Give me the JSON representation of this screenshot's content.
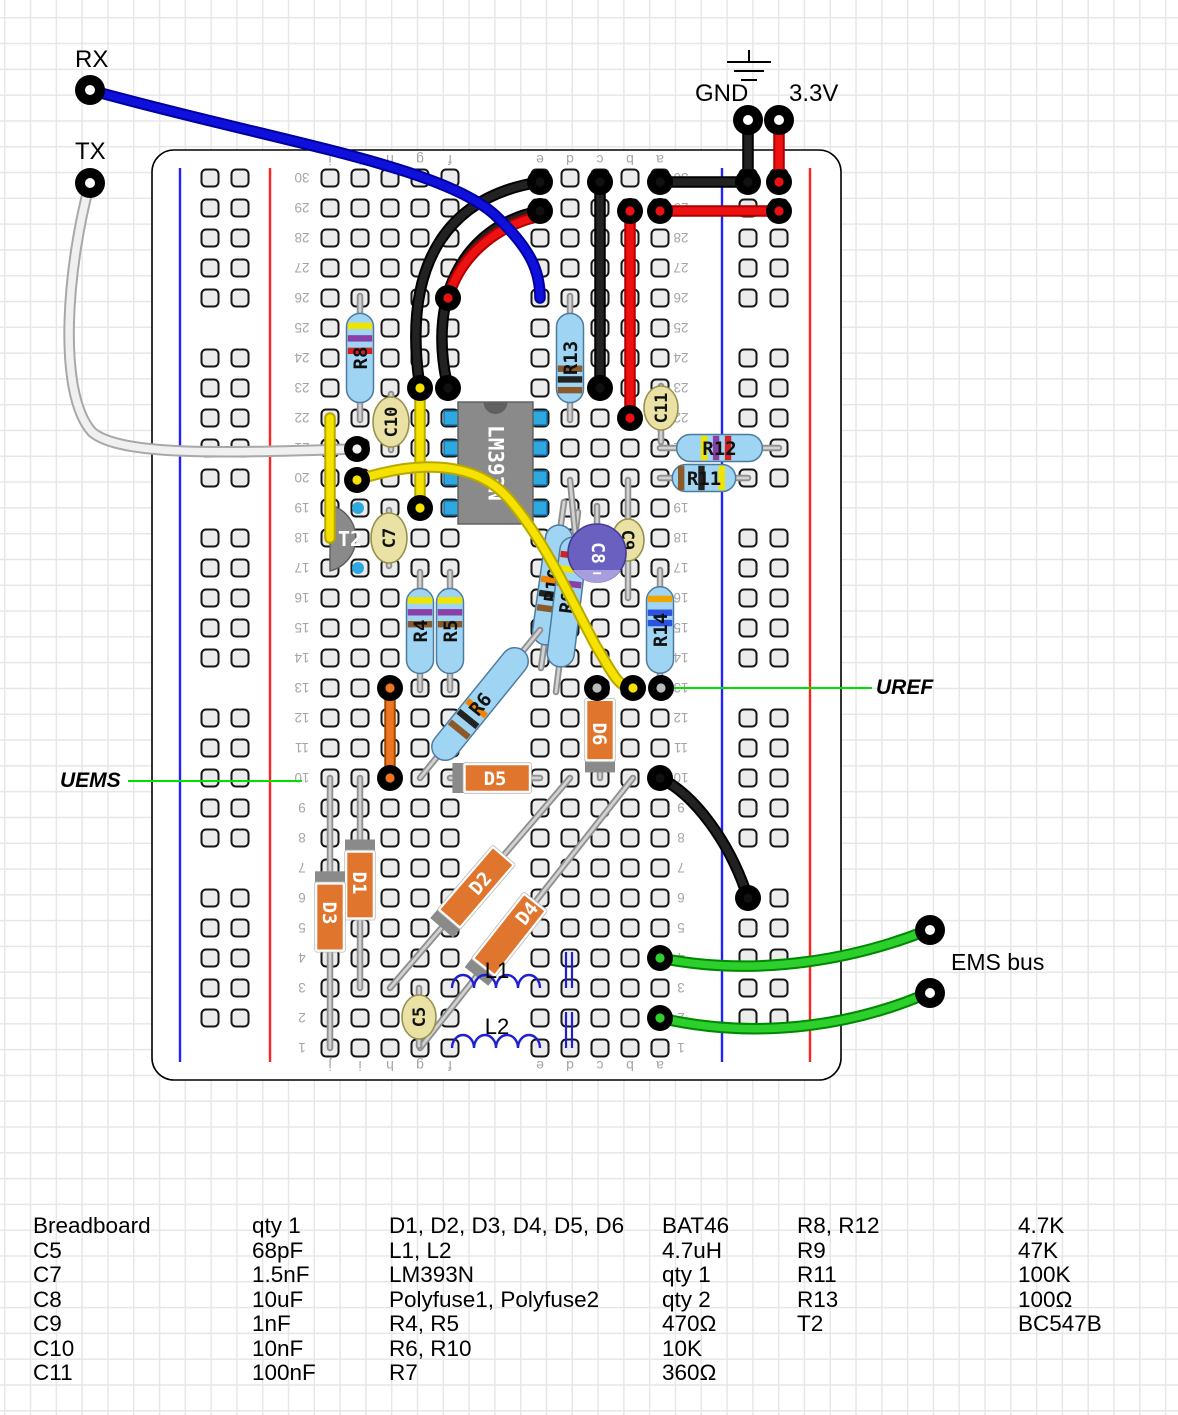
{
  "annotations": {
    "rx": "RX",
    "tx": "TX",
    "gnd": "GND",
    "v33": "3.3V",
    "uref": "UREF",
    "uems": "UEMS",
    "ems_bus": "EMS bus"
  },
  "board": {
    "row_numbers": [
      "1",
      "2",
      "3",
      "4",
      "5",
      "6",
      "7",
      "8",
      "9",
      "10",
      "11",
      "12",
      "13",
      "14",
      "15",
      "16",
      "17",
      "18",
      "19",
      "20",
      "21",
      "22",
      "23",
      "24",
      "25",
      "26",
      "27",
      "28",
      "29",
      "30"
    ],
    "column_letters": [
      "a",
      "b",
      "c",
      "d",
      "e",
      "f",
      "g",
      "h",
      "i",
      "j"
    ]
  },
  "colors": {
    "wire_black": "#1a1a1a",
    "wire_red": "#ee1111",
    "wire_blue": "#1010dd",
    "wire_yellow": "#f6e200",
    "wire_green": "#2ccf2c",
    "wire_orange": "#ee7622",
    "wire_white": "#f0f0f0",
    "annotation_green": "#00e100",
    "resistor_body": "#9fd5f2",
    "diode_body": "#e0762e",
    "cap_body": "#e9e2a4",
    "ecap_body": "#6a60c0",
    "ic_body": "#8a8a8a",
    "rail_red": "#ff2222",
    "rail_blue": "#2222ff"
  },
  "components": [
    {
      "t": "res",
      "label": "R8",
      "x1": 360,
      "y1": 420,
      "x2": 360,
      "y2": 296,
      "bands": [
        [
          0.86,
          "#efe400"
        ],
        [
          0.72,
          "#8a3fa8"
        ],
        [
          0.58,
          "#d42222"
        ]
      ]
    },
    {
      "t": "res",
      "label": "R13",
      "x1": 570,
      "y1": 420,
      "x2": 570,
      "y2": 296,
      "bands": [
        [
          0.38,
          "#8a5a2a"
        ],
        [
          0.26,
          "#222222"
        ],
        [
          0.14,
          "#8a5a2a"
        ]
      ]
    },
    {
      "t": "res",
      "label": "R12",
      "x1": 660,
      "y1": 448,
      "x2": 779,
      "y2": 448,
      "bands": [
        [
          0.32,
          "#efe400"
        ],
        [
          0.46,
          "#8a3fa8"
        ],
        [
          0.6,
          "#d42222"
        ]
      ]
    },
    {
      "t": "res",
      "label": "R11",
      "x1": 660,
      "y1": 478,
      "x2": 748,
      "y2": 478,
      "bands": [
        [
          0.14,
          "#8a5a2a"
        ],
        [
          0.46,
          "#222222"
        ],
        [
          0.78,
          "#efe400"
        ]
      ]
    },
    {
      "t": "res",
      "label": "R4",
      "x1": 420,
      "y1": 690,
      "x2": 420,
      "y2": 572,
      "bands": [
        [
          0.86,
          "#efe400"
        ],
        [
          0.72,
          "#8a3fa8"
        ],
        [
          0.58,
          "#8a5a2a"
        ]
      ]
    },
    {
      "t": "res",
      "label": "R5",
      "x1": 450,
      "y1": 690,
      "x2": 450,
      "y2": 572,
      "bands": [
        [
          0.86,
          "#efe400"
        ],
        [
          0.72,
          "#8a3fa8"
        ],
        [
          0.58,
          "#8a5a2a"
        ]
      ]
    },
    {
      "t": "res",
      "label": "R14",
      "x1": 660,
      "y1": 690,
      "x2": 660,
      "y2": 570,
      "bands": [
        [
          0.86,
          "#efa400"
        ],
        [
          0.7,
          "#2b52e0"
        ],
        [
          0.58,
          "#2b52e0"
        ]
      ]
    },
    {
      "t": "res",
      "label": "R10",
      "x1": 541,
      "y1": 668,
      "x2": 564,
      "y2": 502,
      "bands": [
        [
          0.3,
          "#8a5a2a"
        ],
        [
          0.42,
          "#222222"
        ],
        [
          0.54,
          "#ef8400"
        ]
      ]
    },
    {
      "t": "res",
      "label": "R9",
      "x1": 556,
      "y1": 692,
      "x2": 578,
      "y2": 512,
      "bands": [
        [
          0.64,
          "#8a3fa8"
        ],
        [
          0.75,
          "#efe400"
        ],
        [
          0.86,
          "#d42222"
        ]
      ]
    },
    {
      "t": "res",
      "label": "R6",
      "x1": 420,
      "y1": 778,
      "x2": 540,
      "y2": 630,
      "bands": [
        [
          0.26,
          "#8a5a2a"
        ],
        [
          0.36,
          "#222222"
        ],
        [
          0.46,
          "#ef8400"
        ]
      ]
    },
    {
      "t": "dio",
      "label": "D1",
      "x1": 360,
      "y1": 778,
      "x2": 360,
      "y2": 988,
      "b0": 0.35,
      "b1": 0.67,
      "bar": "start"
    },
    {
      "t": "dio",
      "label": "D3",
      "x1": 330,
      "y1": 778,
      "x2": 330,
      "y2": 1048,
      "b0": 0.39,
      "b1": 0.64,
      "bar": "start"
    },
    {
      "t": "dio",
      "label": "D6",
      "x1": 600,
      "y1": 690,
      "x2": 600,
      "y2": 778,
      "b0": 0.11,
      "b1": 0.8,
      "bar": "end"
    },
    {
      "t": "dio",
      "label": "D5",
      "x1": 450,
      "y1": 778,
      "x2": 540,
      "y2": 778,
      "b0": 0.16,
      "b1": 0.89,
      "bar": "start"
    },
    {
      "t": "dio",
      "label": "D2",
      "x1": 390,
      "y1": 988,
      "x2": 570,
      "y2": 778,
      "b0": 0.33,
      "b1": 0.63,
      "bar": "start"
    },
    {
      "t": "dio",
      "label": "D4",
      "x1": 420,
      "y1": 1048,
      "x2": 633,
      "y2": 778,
      "b0": 0.3,
      "b1": 0.54,
      "bar": "start"
    },
    {
      "t": "cap",
      "label": "C10",
      "x": 391,
      "y": 422,
      "l1": 394,
      "l2": 450,
      "rx": 18,
      "ry": 25,
      "rot": -90
    },
    {
      "t": "cap",
      "label": "C7",
      "x": 389,
      "y": 538,
      "l1": 510,
      "l2": 566,
      "rx": 18,
      "ry": 25,
      "rot": -90
    },
    {
      "t": "cap",
      "label": "C9",
      "x": 628,
      "y": 540,
      "l1": 480,
      "l2": 598,
      "rx": 16,
      "ry": 21,
      "rot": 90
    },
    {
      "t": "cap",
      "label": "C11",
      "x": 661,
      "y": 408,
      "l1": 386,
      "l2": 442,
      "rx": 17,
      "ry": 22,
      "rot": -90
    },
    {
      "t": "cap",
      "label": "C5",
      "x": 419,
      "y": 1017,
      "l1": 988,
      "l2": 1046,
      "rx": 17,
      "ry": 22,
      "rot": -90
    },
    {
      "t": "ecap",
      "label": "C8",
      "x": 597,
      "y": 553,
      "r": 29,
      "minus": "−"
    },
    {
      "t": "ic",
      "label": "LM393N",
      "x": 458,
      "y": 402,
      "w": 75,
      "h": 122,
      "pinys": [
        418,
        448,
        478,
        508
      ]
    },
    {
      "t": "tr",
      "label": "T2",
      "x": 352,
      "y": 538,
      "r": 34
    },
    {
      "t": "ind",
      "label": "L1",
      "x1": 452,
      "x2": 540,
      "y": 988,
      "bx": [
        566,
        572
      ],
      "by1": 952,
      "by2": 988,
      "lx": 497,
      "ly": 971
    },
    {
      "t": "ind",
      "label": "L2",
      "x1": 452,
      "x2": 540,
      "y": 1048,
      "bx": [
        566,
        572
      ],
      "by1": 1012,
      "by2": 1048,
      "lx": 497,
      "ly": 1027
    }
  ],
  "wires": [
    {
      "n": "wire-gnd-row30",
      "c": "black",
      "d": "M660,182 L748,182"
    },
    {
      "n": "wire-33v-row29",
      "c": "red",
      "d": "M660,211 L779,211"
    },
    {
      "n": "wire-gnd-pin",
      "c": "black",
      "d": "M748,120 L748,182"
    },
    {
      "n": "wire-33v-pin",
      "c": "red",
      "d": "M779,120 L779,182"
    },
    {
      "n": "wire-col-c",
      "c": "black",
      "d": "M600,182 L600,388"
    },
    {
      "n": "wire-col-b",
      "c": "red",
      "d": "M630,211 L630,418"
    },
    {
      "n": "wire-arc-a",
      "c": "black",
      "d": "M540,182 C455,195 400,255 420,388"
    },
    {
      "n": "wire-arc-b",
      "c": "black",
      "d": "M540,211 C470,224 425,290 448,388"
    },
    {
      "n": "wire-red-arc",
      "c": "red",
      "d": "M448,298 C462,250 505,222 542,216"
    },
    {
      "n": "wire-rx",
      "c": "blue",
      "d": "M90,90 C270,140 440,165 495,215 C532,250 540,272 540,298"
    },
    {
      "n": "wire-tx",
      "c": "white",
      "d": "M90,183 C68,262 56,392 92,432 C122,458 242,452 354,449"
    },
    {
      "n": "wire-yellow-j",
      "c": "yellow",
      "d": "M330,418 L330,538"
    },
    {
      "n": "wire-yellow-g",
      "c": "yellow",
      "d": "M420,388 L420,508"
    },
    {
      "n": "wire-yellow-s",
      "c": "yellow",
      "d": "M357,480 C425,458 478,464 508,498 C545,540 572,602 596,646 C612,672 618,688 633,688"
    },
    {
      "n": "wire-orange",
      "c": "orange",
      "d": "M390,688 L390,778"
    },
    {
      "n": "wire-a10-rail",
      "c": "black",
      "d": "M660,778 C694,794 730,842 748,898"
    },
    {
      "n": "wire-ems-1",
      "c": "green",
      "d": "M660,958 C760,978 858,958 928,930"
    },
    {
      "n": "wire-ems-2",
      "c": "green",
      "d": "M660,1018 C765,1042 862,1022 928,993"
    }
  ],
  "rings": [
    [
      748,
      182,
      "#111"
    ],
    [
      779,
      182,
      "#ee1111"
    ],
    [
      779,
      211,
      "#ee1111"
    ],
    [
      660,
      182,
      "#111"
    ],
    [
      660,
      211,
      "#ee1111"
    ],
    [
      600,
      182,
      "#111"
    ],
    [
      600,
      388,
      "#111"
    ],
    [
      630,
      211,
      "#ee1111"
    ],
    [
      630,
      418,
      "#ee1111"
    ],
    [
      540,
      182,
      "#111"
    ],
    [
      540,
      211,
      "#111"
    ],
    [
      420,
      388,
      "#f6e200"
    ],
    [
      448,
      388,
      "#111"
    ],
    [
      448,
      298,
      "#ee1111"
    ],
    [
      420,
      508,
      "#f6e200"
    ],
    [
      357,
      449,
      "#f0f0f0"
    ],
    [
      357,
      480,
      "#f6e200"
    ],
    [
      390,
      688,
      "#ee7622"
    ],
    [
      390,
      778,
      "#ee7622"
    ],
    [
      597,
      688,
      "#bbbbbb"
    ],
    [
      633,
      688,
      "#f6e200"
    ],
    [
      661,
      688,
      "#bbbbbb"
    ],
    [
      660,
      778,
      "#111"
    ],
    [
      748,
      898,
      "#111"
    ],
    [
      660,
      958,
      "#2ccf2c"
    ],
    [
      660,
      1018,
      "#2ccf2c"
    ]
  ],
  "pins": [
    {
      "n": "pin-rx",
      "x": 90,
      "y": 90
    },
    {
      "n": "pin-tx",
      "x": 90,
      "y": 183
    },
    {
      "n": "pin-gnd",
      "x": 748,
      "y": 120
    },
    {
      "n": "pin-33v",
      "x": 779,
      "y": 120
    },
    {
      "n": "pin-ems-1",
      "x": 930,
      "y": 930
    },
    {
      "n": "pin-ems-2",
      "x": 930,
      "y": 993
    }
  ],
  "annotation_lines": [
    {
      "n": "uref-pointer-line",
      "d": "M668,688 L872,688"
    },
    {
      "n": "uems-pointer-line",
      "d": "M128,781 L302,781"
    }
  ],
  "parts_list": {
    "columns": [
      {
        "x": 33,
        "items": [
          "Breadboard",
          "C5",
          "C7",
          "C8",
          "C9",
          "C10",
          "C11"
        ]
      },
      {
        "x": 252,
        "items": [
          "qty 1",
          "68pF",
          "1.5nF",
          "10uF",
          "1nF",
          "10nF",
          "100nF"
        ]
      },
      {
        "x": 389,
        "items": [
          "D1, D2, D3, D4, D5, D6",
          "L1, L2",
          "LM393N",
          "Polyfuse1, Polyfuse2",
          "R4, R5",
          "R6, R10",
          "R7"
        ]
      },
      {
        "x": 662,
        "items": [
          "BAT46",
          "4.7uH",
          "qty 1",
          "qty 2",
          "470Ω",
          "10K",
          "360Ω"
        ]
      },
      {
        "x": 797,
        "items": [
          "R8, R12",
          "R9",
          "R11",
          "R13",
          "T2"
        ]
      },
      {
        "x": 1018,
        "items": [
          "4.7K",
          "47K",
          "100K",
          "100Ω",
          "BC547B"
        ]
      }
    ]
  }
}
